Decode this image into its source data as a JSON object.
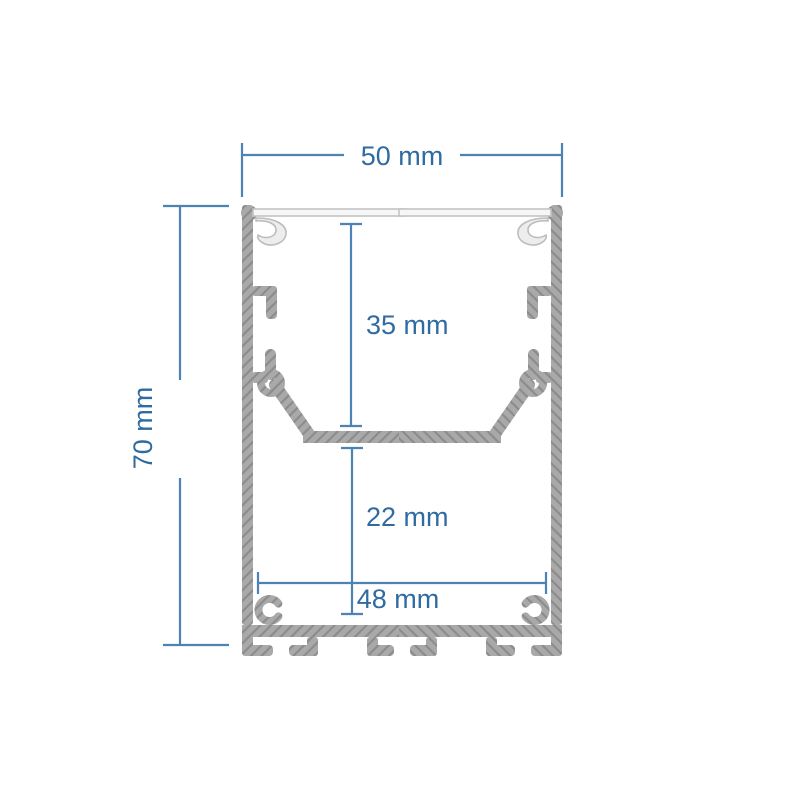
{
  "drawing": {
    "kind": "aluminium-led-profile-cross-section",
    "labels": {
      "outer_width": "50 mm",
      "outer_height": "70 mm",
      "upper_cavity_depth": "35 mm",
      "lower_cavity_depth": "22 mm",
      "inner_width": "48 mm"
    },
    "colors": {
      "background": "#ffffff",
      "dimension_line": "#4d82b5",
      "dimension_text": "#2f6ba1",
      "profile_fill": "#a9a9a9",
      "profile_hatch": "#8b8b8b",
      "diffuser_fill": "#f6f6f6",
      "diffuser_outline": "#c3c3c3"
    }
  }
}
